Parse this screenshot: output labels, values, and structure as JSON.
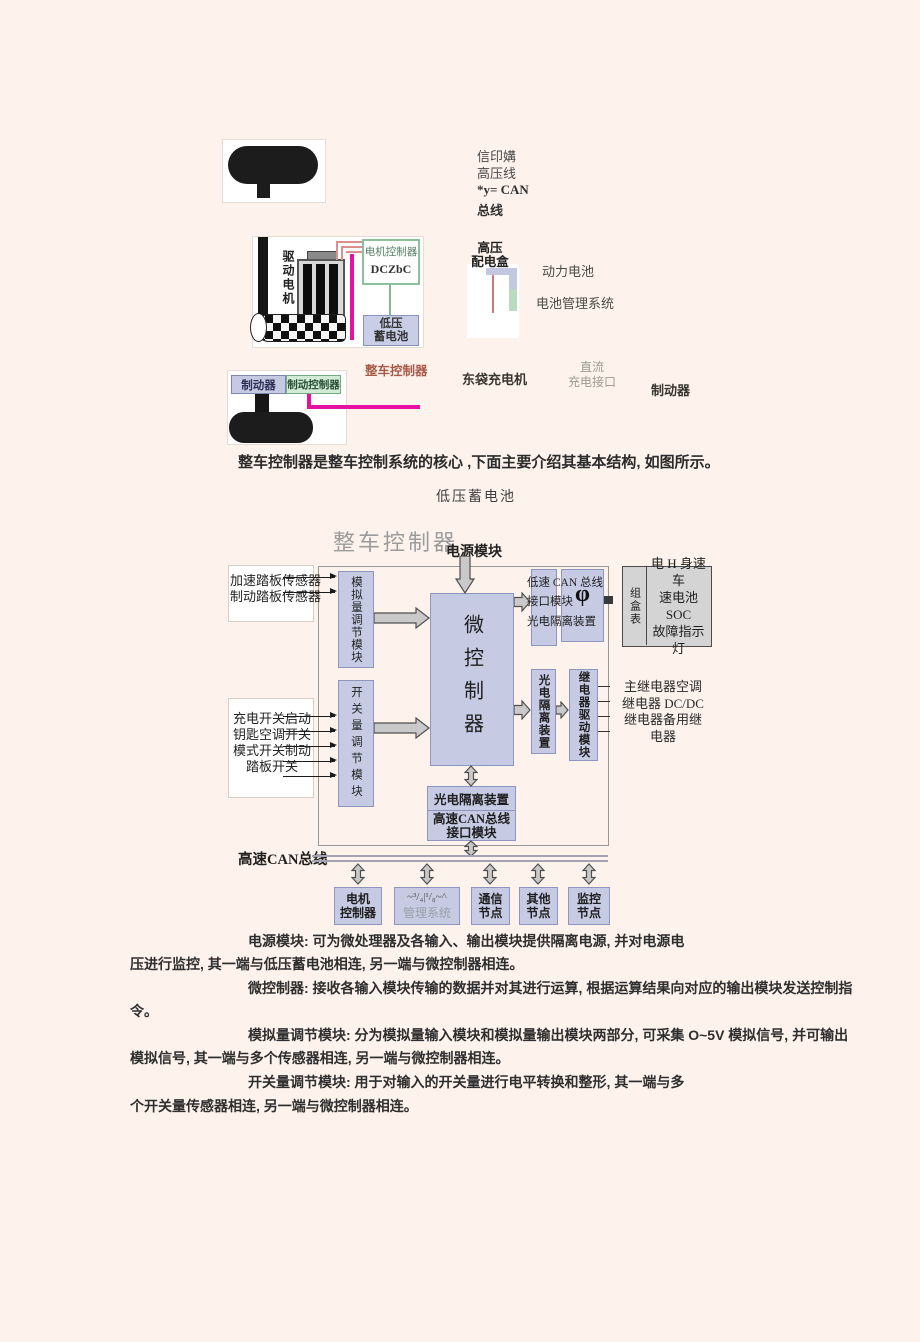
{
  "figure": {
    "legend1": "信印媾",
    "legend2": "高压线",
    "legend3": "*y= CAN",
    "legend4": "总线",
    "drive_motor": "驱动电机",
    "motor_controller": "电机控制器",
    "motor_controller_sub": "DCZbC",
    "lv_battery_small": "低压\n蓄电池",
    "hv_dist_box": "高压\n配电盒",
    "power_battery": "动力电池",
    "bms": "电池管理系统",
    "vcu_red": "整车控制器",
    "brake_left": "制动器",
    "brake_controller": "制动控制器",
    "charger": "东袋充电机",
    "dc_port": "直流\n充电接口",
    "brake_right": "制动器"
  },
  "intro": {
    "sentence": "整车控制器是整车控制系统的核心 ,下面主要介绍其基本结构,  如图所示。",
    "caption_lv_battery": "低压蓄电池"
  },
  "diagram": {
    "title": "整车控制器",
    "power_module": "电源模块",
    "analog_inputs": [
      "加速踏板传感器",
      "制动踏板传感器"
    ],
    "switch_inputs": [
      "充电开关启动",
      "钥匙空调开关",
      "模式开关制动",
      "踏板开关"
    ],
    "analog_module": "模拟量调节模块",
    "switch_module": "开关量调节模块",
    "mcu": "微控制器",
    "low_can_text1": "低速 CAN 总线",
    "low_can_text2": "接口模块",
    "low_can_phi": "φ",
    "low_can_text3": "光电隔离装置",
    "cluster_vert": "组盒表",
    "cluster_text": "电 H 身速车\n速电池 SOC\n故障指示灯",
    "opto_right": "光电隔离装置",
    "relay_module": "继电器驱动模块",
    "relay_list": "主继电器空调\n继电器 DC/DC\n继电器备用继\n电器",
    "opto_bottom": "光电隔离装置",
    "hs_can_interface": "高速CAN总线\n接口模块",
    "bus_label": "高速CAN总线",
    "node1": "电机\n控制器",
    "node2_top": "~³/₄|¹/₈~^",
    "node2_bottom": "管理系统",
    "node3": "通信\n节点",
    "node4": "其他\n节点",
    "node5": "监控\n节点"
  },
  "body": {
    "p1l1": "电源模块: 可为微处理器及各输入、输出模块提供隔离电源, 并对电源电",
    "p1l2": "压进行监控, 其一端与低压蓄电池相连, 另一端与微控制器相连。",
    "p2l1": "微控制器: 接收各输入模块传输的数据并对其进行运算, 根据运算结果向对应的输出模块发送控制指",
    "p2l2": "令。",
    "p3l1": "模拟量调节模块: 分为模拟量输入模块和模拟量输出模块两部分, 可采集 O~5V 模拟信号, 并可输出",
    "p3l2": "模拟信号, 其一端与多个传感器相连, 另一端与微控制器相连。",
    "p4l1": "开关量调节模块: 用于对输入的开关量进行电平转换和整形, 其一端与多",
    "p4l2": "个开关量传感器相连, 另一端与微控制器相连。"
  },
  "colors": {
    "page_bg": "#fdf3ec",
    "lavender_fill": "#c6cae3",
    "lavender_border": "#8d94bd",
    "green_fill": "#d2ebd6",
    "green_border": "#74ad82",
    "magenta": "#e611a0",
    "red_label": "#a85a48",
    "gray_title": "#9b9b9b"
  }
}
